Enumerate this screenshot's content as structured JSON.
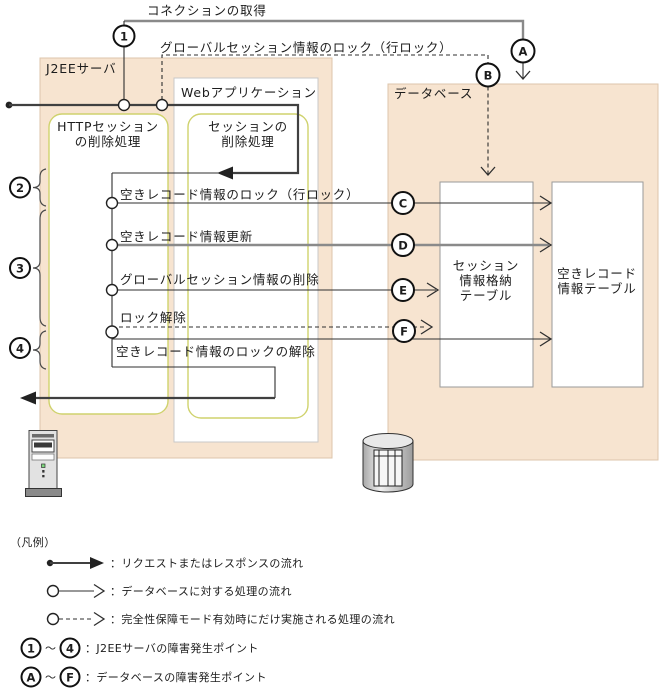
{
  "title_labels": {
    "connection": "コネクションの取得",
    "global_session_lock": "グローバルセッション情報のロック（行ロック）"
  },
  "containers": {
    "j2ee_server": "J2EEサーバ",
    "web_application": "Webアプリケーション",
    "database": "データベース"
  },
  "process_boxes": {
    "http_session": [
      "HTTPセッション",
      "の削除処理"
    ],
    "session_delete": [
      "セッションの",
      "削除処理"
    ]
  },
  "db_tables": {
    "session_table": [
      "セッション",
      "情報格納",
      "テーブル"
    ],
    "free_record_table": [
      "空きレコード",
      "情報テーブル"
    ]
  },
  "flow_labels": {
    "free_record_lock": "空きレコード情報のロック（行ロック）",
    "free_record_update": "空きレコード情報更新",
    "global_session_delete": "グローバルセッション情報の削除",
    "lock_release": "ロック解除",
    "free_record_lock_release": "空きレコード情報のロックの解除"
  },
  "points": {
    "n1": "1",
    "n2": "2",
    "n3": "3",
    "n4": "4",
    "a": "A",
    "b": "B",
    "c": "C",
    "d": "D",
    "e": "E",
    "f": "F"
  },
  "legend": {
    "title": "（凡例）",
    "tilde": "～",
    "rows": [
      {
        "label": "：リクエストまたはレスポンスの流れ"
      },
      {
        "label": "：データベースに対する処理の流れ"
      },
      {
        "label": "：完全性保障モード有効時にだけ実施される処理の流れ"
      },
      {
        "label": "：J2EEサーバの障害発生ポイント",
        "from": "1",
        "to": "4"
      },
      {
        "label": "：データベースの障害発生ポイント",
        "from": "A",
        "to": "F"
      }
    ]
  },
  "colors": {
    "container_fill": "#f7e4d0",
    "container_border": "#dcc5ab",
    "process_box_border": "#cfd26d",
    "line_dark": "#404040",
    "line_gray": "#8a8a8a",
    "text": "#1c1c1c"
  }
}
